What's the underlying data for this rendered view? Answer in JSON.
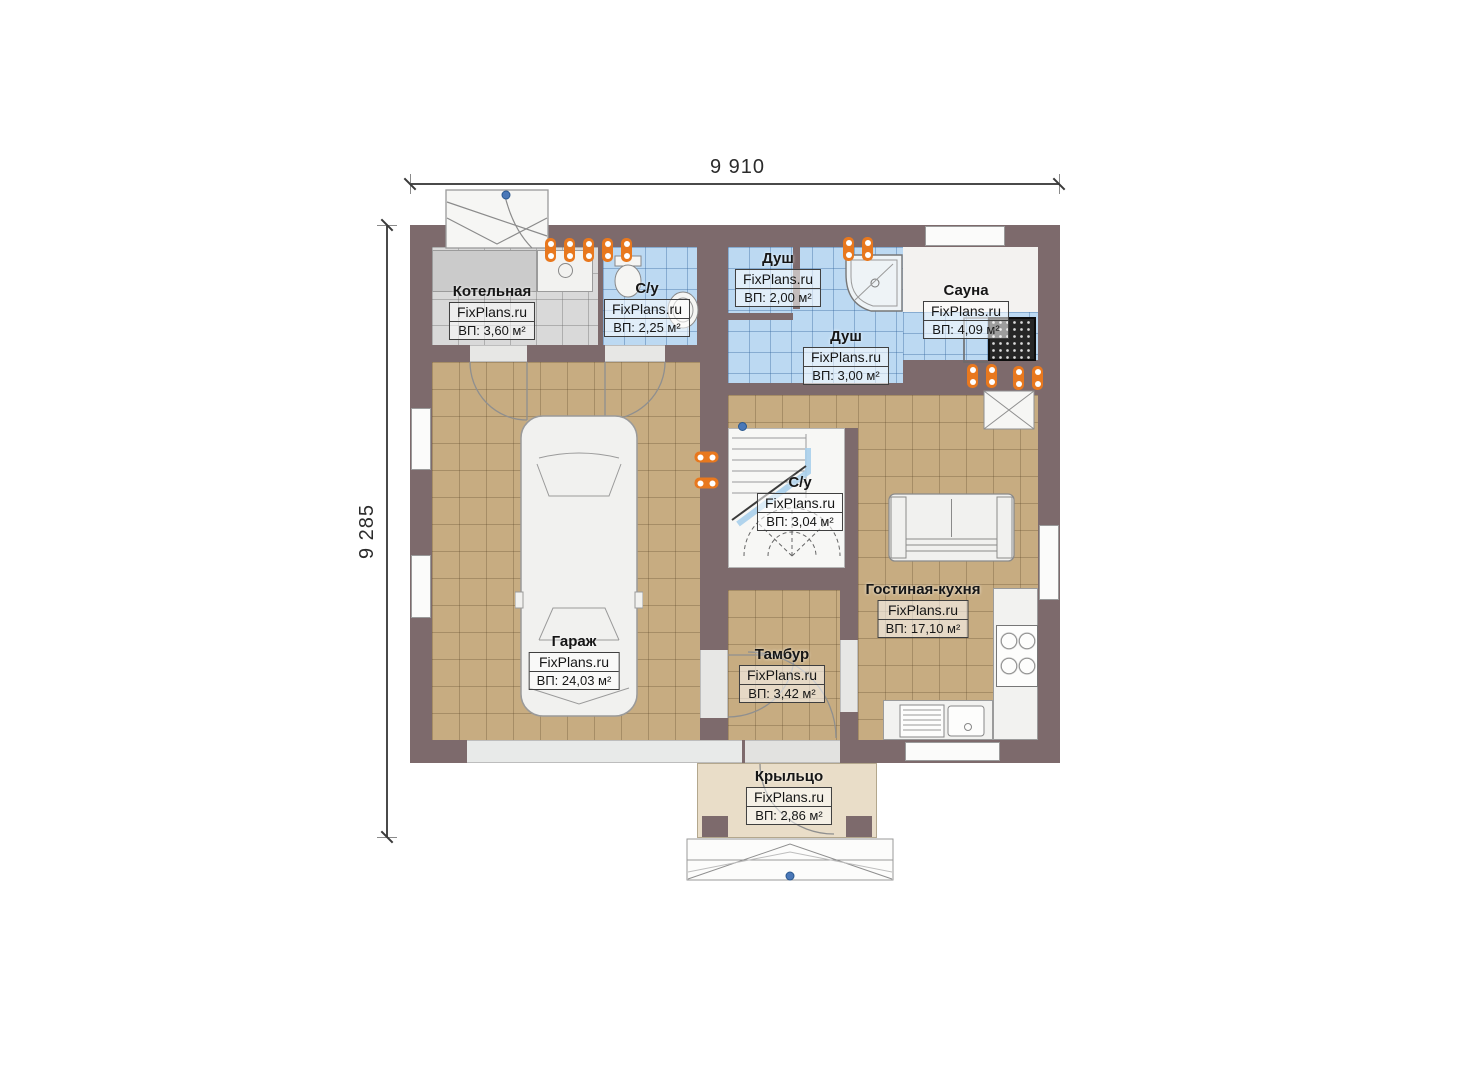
{
  "plan": {
    "type": "floor-plan",
    "watermark": "FixPlans.ru"
  },
  "dimensions": {
    "top": "9 910",
    "left": "9 285"
  },
  "rooms": [
    {
      "id": "boiler",
      "name": "Котельная",
      "watermark": "FixPlans.ru",
      "area": "ВП: 3,60 м²"
    },
    {
      "id": "wc-1",
      "name": "С/у",
      "watermark": "FixPlans.ru",
      "area": "ВП: 2,25 м²"
    },
    {
      "id": "shower-1",
      "name": "Душ",
      "watermark": "FixPlans.ru",
      "area": "ВП: 2,00 м²"
    },
    {
      "id": "shower-2",
      "name": "Душ",
      "watermark": "FixPlans.ru",
      "area": "ВП: 3,00 м²"
    },
    {
      "id": "sauna",
      "name": "Сауна",
      "watermark": "FixPlans.ru",
      "area": "ВП: 4,09 м²"
    },
    {
      "id": "wc-2",
      "name": "С/у",
      "watermark": "FixPlans.ru",
      "area": "ВП: 3,04 м²"
    },
    {
      "id": "garage",
      "name": "Гараж",
      "watermark": "FixPlans.ru",
      "area": "ВП: 24,03 м²"
    },
    {
      "id": "vestibule",
      "name": "Тамбур",
      "watermark": "FixPlans.ru",
      "area": "ВП: 3,42 м²"
    },
    {
      "id": "living-kitchen",
      "name": "Гостиная-кухня",
      "watermark": "FixPlans.ru",
      "area": "ВП: 17,10 м²"
    },
    {
      "id": "porch",
      "name": "Крыльцо",
      "watermark": "FixPlans.ru",
      "area": "ВП: 2,86 м²"
    }
  ],
  "colors": {
    "wall": "#7d6a6c",
    "floor_tan": "#c7ac81",
    "floor_blue": "#bcd9f2",
    "floor_gray": "#d9d9d9",
    "porch": "#e9ddc8",
    "radiator": "#e8781e",
    "marker_blue": "#4a78b8"
  }
}
